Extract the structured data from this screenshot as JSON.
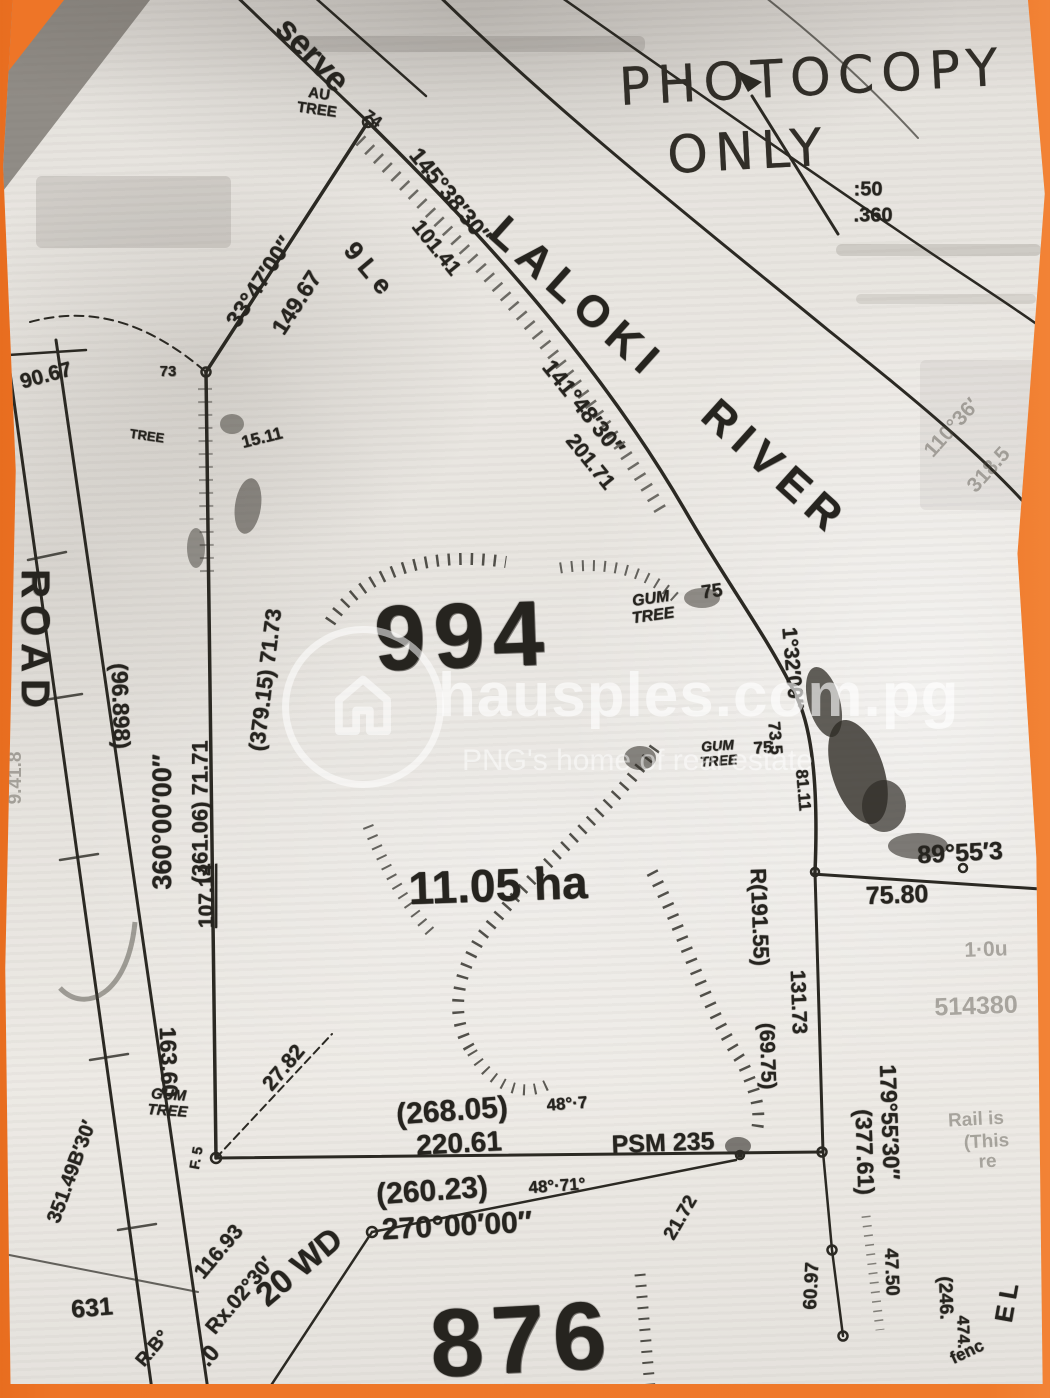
{
  "stamp": {
    "line1": "PHOTOCOPY",
    "line2": "ONLY"
  },
  "watermark": {
    "brand": "hausples.com.pg",
    "tagline": "PNG's home of real estate",
    "icon": "house-circle-icon"
  },
  "parcels": {
    "lot_number": "994",
    "area": "11.05 ha",
    "adjacent_lot_number": "876"
  },
  "features": {
    "river_name_line1": "LALOKI",
    "river_name_line2": "RIVER",
    "road_label": "ROAD",
    "reserve_fragment": "serve",
    "au_tree": "AU\nTREE",
    "gum_tree": "GUM\nTREE",
    "tree_small": "TREE"
  },
  "labels": {
    "frag_colon50": ":50",
    "frag_360": ".360",
    "corner_74": "74",
    "n_bearing": "145°38′30″",
    "n_distance": "101.41",
    "nw_bearing": "33°47′00″",
    "nw_distance": "149.67",
    "frag_gle": "9 L e",
    "river_bearing": "141°48′30″",
    "river_distance": "201.71",
    "d_9067": "90.67",
    "pt_73": "73",
    "d_1511": "15.11",
    "frag_941": "9.41.8",
    "paren_96898": "(96.898)",
    "w_bearing": "360°00′00″",
    "w_paren": "(361.06)  71.71",
    "w_paren2": "(379.15)  71.73",
    "d_10714": "107.14",
    "n75": "75",
    "e_bearing": "1°32′00″",
    "e_frag1": "73.5",
    "e_frag2": "81.11",
    "se_bearing": "89°55′3",
    "d_7580": "75.80",
    "r_19155": "R(191.55)",
    "d_13173": "131.73",
    "paren_6975": "(69.75)",
    "faint_514380": "514380",
    "faint_10u": "1·0u",
    "faint_11036": "110°36′",
    "faint_3185": "318.5",
    "d_2782": "27.82",
    "d_16360": "163.60",
    "frag_35149": "351.49B′30′",
    "frag_f5": "F. 5",
    "paren_26805": "(268.05)",
    "frag_487": "48°·7",
    "d_22061": "220.61",
    "psm_235": "PSM 235",
    "paren_26023": "(260.23)",
    "frag_4871": "48°·71°",
    "s_bearing": "270°00′00″",
    "d_2172": "21.72",
    "e2_bearing": "179°55′30″",
    "paren_37761": "(377.61)",
    "d_4750": "47.50",
    "d_6097": "60.97",
    "paren_246": "(246.",
    "frag_474": "474.",
    "frag_fenc": "fenc",
    "frag_el": "E L",
    "faint_rail": "Rail is",
    "faint_this": "(This re",
    "n_631": "631",
    "d_11693": "116.93",
    "rx_0230": "Rx.02°30′",
    "wd_20": "20 WD",
    "frag_rb": "R.B°",
    "frag_0": ".0"
  },
  "colors": {
    "background_orange": "#ee7527",
    "paper_gray": "#e6e3de",
    "ink": "#2b2923"
  }
}
